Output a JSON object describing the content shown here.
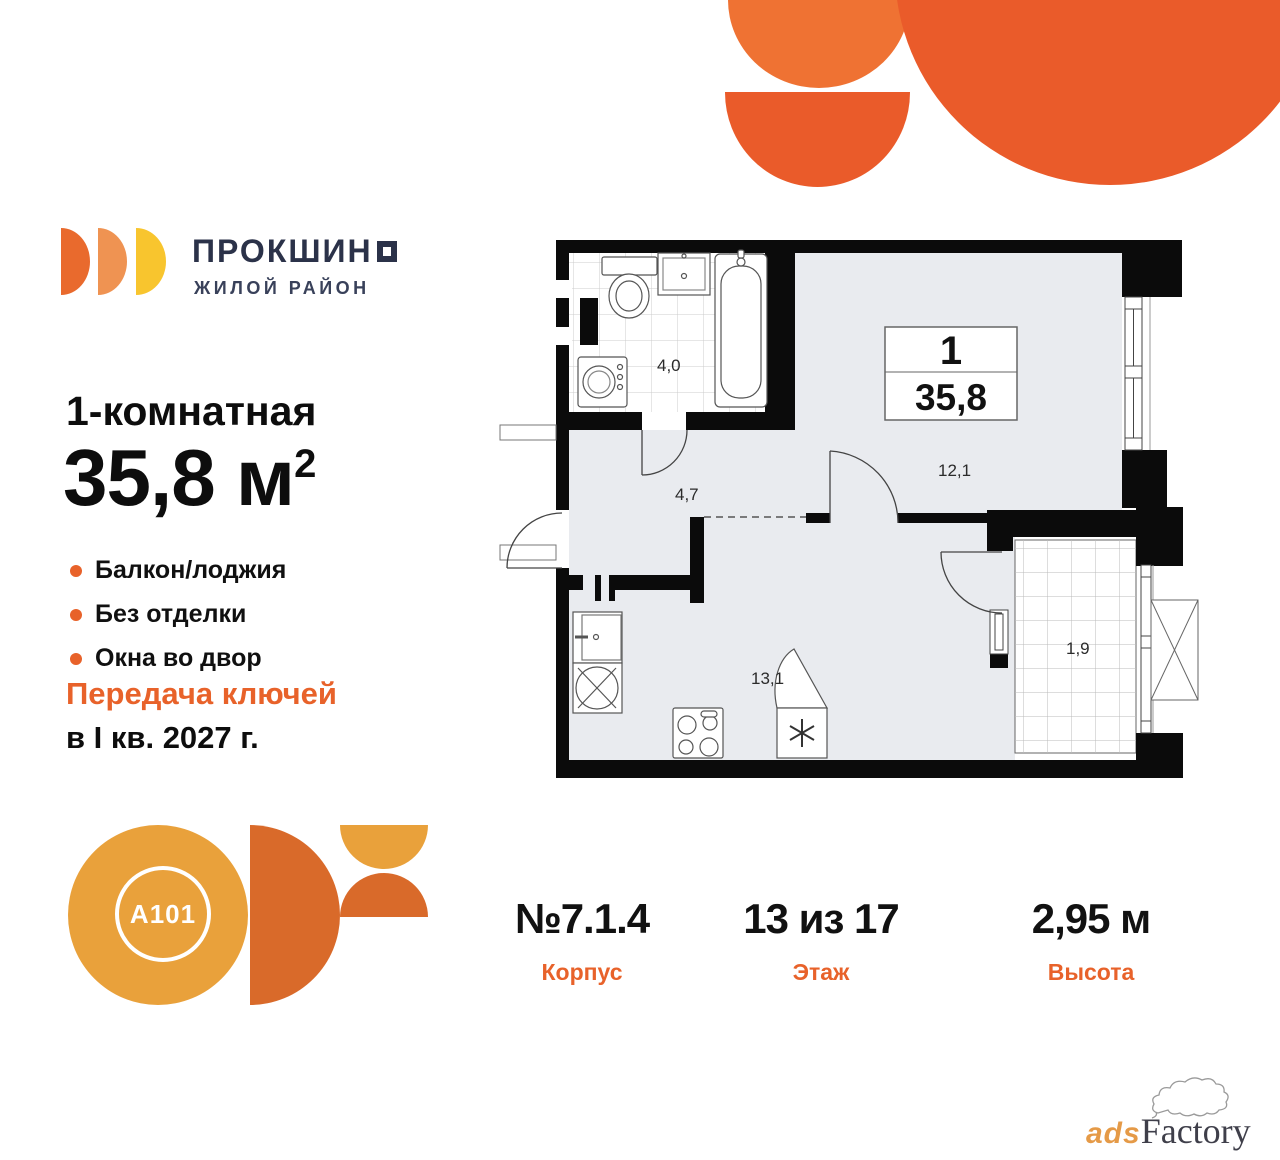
{
  "brand": {
    "logo_text": "ПРОКШИН",
    "logo_subtitle": "ЖИЛОЙ РАЙОН"
  },
  "listing": {
    "title": "1-комнатная",
    "area_value": "35,8",
    "area_unit": " м",
    "area_sup": "2",
    "features": [
      "Балкон/лоджия",
      "Без отделки",
      "Окна во двор"
    ],
    "handover_line1": "Передача ключей",
    "handover_line2": "в I кв. 2027 г."
  },
  "plan": {
    "unit_rooms": "1",
    "unit_area": "35,8",
    "rooms": {
      "bathroom": "4,0",
      "hallway": "4,7",
      "living": "12,1",
      "kitchen": "13,1",
      "balcony": "1,9"
    }
  },
  "details": {
    "columns": [
      {
        "value": "№7.1.4",
        "label": "Корпус"
      },
      {
        "value": "13 из 17",
        "label": "Этаж"
      },
      {
        "value": "2,95 м",
        "label": "Высота"
      }
    ]
  },
  "developer": {
    "badge": "A101"
  },
  "watermark": {
    "part1": "ads",
    "part2": "Factory"
  },
  "colors": {
    "accent_orange": "#E8622A",
    "brand_navy": "#2B3249",
    "logo_orange": "#E96A2D",
    "logo_light_orange": "#EF9352",
    "logo_yellow": "#F8C52E",
    "decor_orange": "#EA5B2A",
    "decor_light_orange": "#EF7233",
    "a101_yellow": "#E9A13B",
    "a101_orange": "#D96A2A",
    "plan_floor": "#E9EBEF",
    "plan_wall": "#0B0B0B"
  }
}
